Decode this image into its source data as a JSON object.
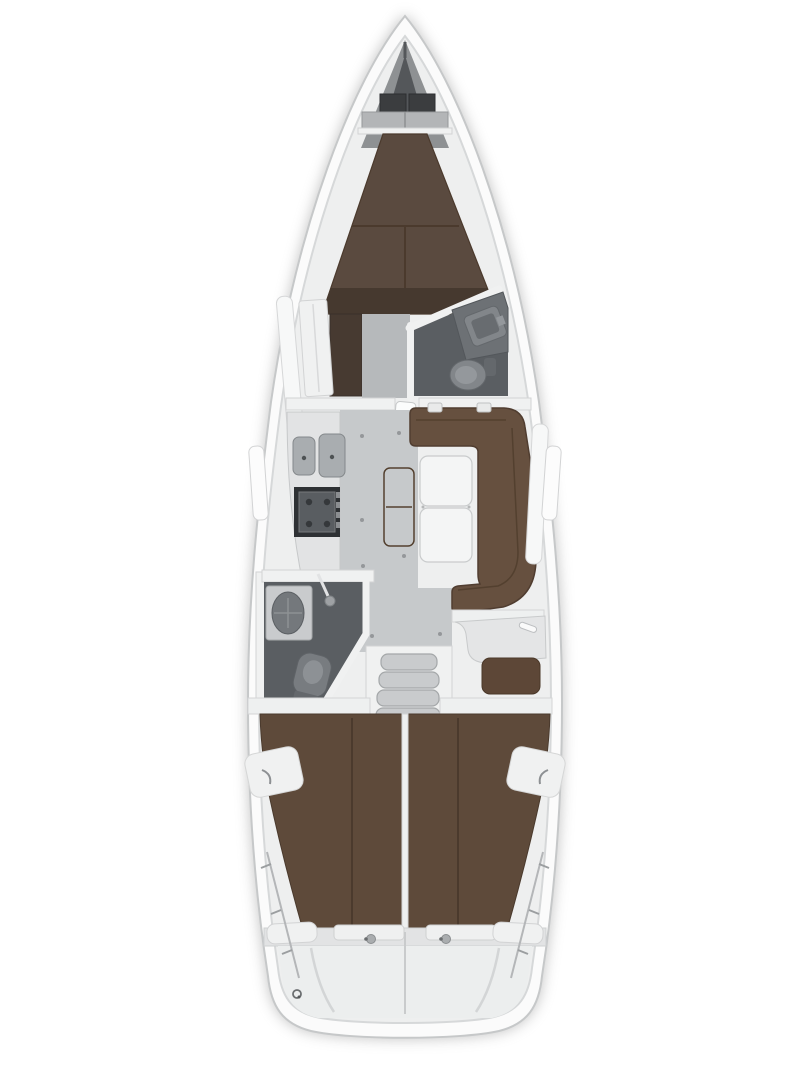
{
  "image": {
    "width": 810,
    "height": 1080,
    "kind": "sailboat-interior-floorplan",
    "orientation": "bow-up"
  },
  "palette": {
    "bg": "#ffffff",
    "hull": "#fbfbfb",
    "hull_stroke": "#c6c8c9",
    "deck": "#eeefef",
    "deck_line": "#d6d8d9",
    "trim": "#f0f1f1",
    "trim_stroke": "#d2d3d4",
    "bow_locker": "#8e9193",
    "bow_dark": "#54575a",
    "bow_box": "#3b3d3f",
    "bow_shelf": "#b3b5b7",
    "berth_fore": "#5a4a3f",
    "berth_rim": "#46392f",
    "berth_aft": "#5e4a3a",
    "berth_seam": "#4b3a2d",
    "dresser": "#473a31",
    "settee": "#66503f",
    "settee_dark": "#503d30",
    "bench": "#6a5140",
    "nav_seat": "#5d4737",
    "nav_desk": "#e4e5e6",
    "pillow": "#f0f1f1",
    "table": "#f4f5f5",
    "table_stroke": "#c9cbcc",
    "floor": "#c6c9cb",
    "floor_fore": "#b6b9bb",
    "head_floor": "#5a5e62",
    "counter": "#e2e3e4",
    "counter_stroke": "#c6c8c9",
    "sink": "#a9adb0",
    "sink_stroke": "#84888b",
    "stove_frame": "#2e3134",
    "stove_top": "#595d61",
    "ceramic": "#82868a",
    "ceramic_dark": "#64686c",
    "ceramic_light": "#94989c",
    "steps": "#c9cbcd",
    "steps_stroke": "#a4a7a9",
    "engine": "#303337",
    "engine_part": "#585c60",
    "engine_part_light": "#9da0a3",
    "metal": "#8d9093",
    "transom": "#e2e3e4",
    "transom_lower": "#eceeee",
    "dot": "#94979a"
  },
  "areas": [
    {
      "id": "anchor-locker"
    },
    {
      "id": "fore-cabin-v-berth"
    },
    {
      "id": "forward-head"
    },
    {
      "id": "wardrobe"
    },
    {
      "id": "galley"
    },
    {
      "id": "salon"
    },
    {
      "id": "salon-table"
    },
    {
      "id": "u-settee"
    },
    {
      "id": "aft-head"
    },
    {
      "id": "nav-station"
    },
    {
      "id": "companionway-steps"
    },
    {
      "id": "engine-room"
    },
    {
      "id": "aft-cabin-port"
    },
    {
      "id": "aft-cabin-starboard"
    },
    {
      "id": "stern-transom"
    }
  ]
}
